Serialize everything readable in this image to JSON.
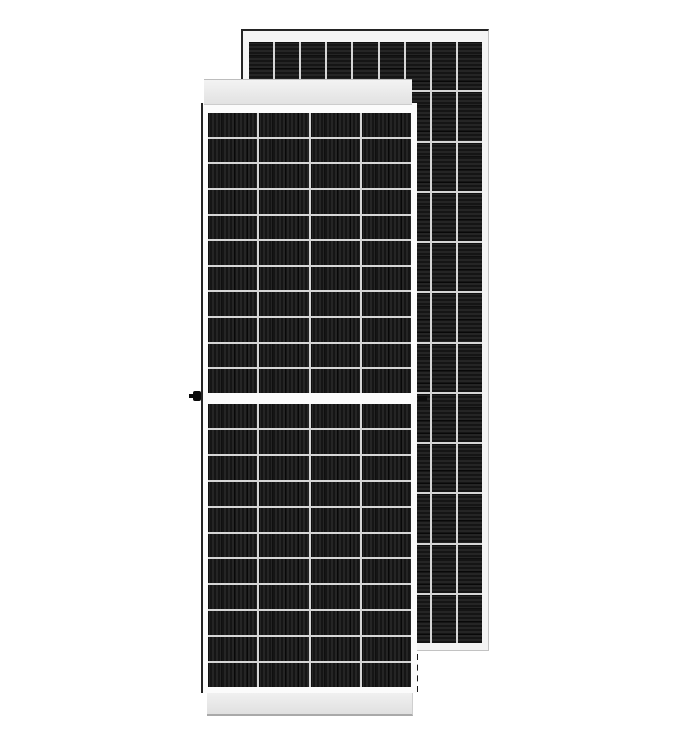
{
  "scene": {
    "description": "Product image of two dark monocrystalline solar panels with white aluminium frames; a front-facing panel overlaps a second panel standing behind it, offset up and to the right",
    "background": "#ffffff"
  },
  "colors": {
    "cell_base": "#151515",
    "cell_stripe": "#252525",
    "separator": "#d6d6d6",
    "frame_white": "#f4f4f4",
    "frame_face": "#fbfbfb",
    "edge_dark": "#242424",
    "edge_light": "#c2c2c2"
  },
  "front_panel": {
    "label": "front solar panel",
    "columns": 4,
    "rows_upper": 11,
    "rows_lower": 11,
    "stripe_direction": "vertical",
    "has_center_gap": true,
    "has_left_connector": true,
    "has_right_connector": true
  },
  "rear_panel": {
    "label": "rear solar panel",
    "columns": 9,
    "rows": 12,
    "stripe_direction": "horizontal"
  }
}
